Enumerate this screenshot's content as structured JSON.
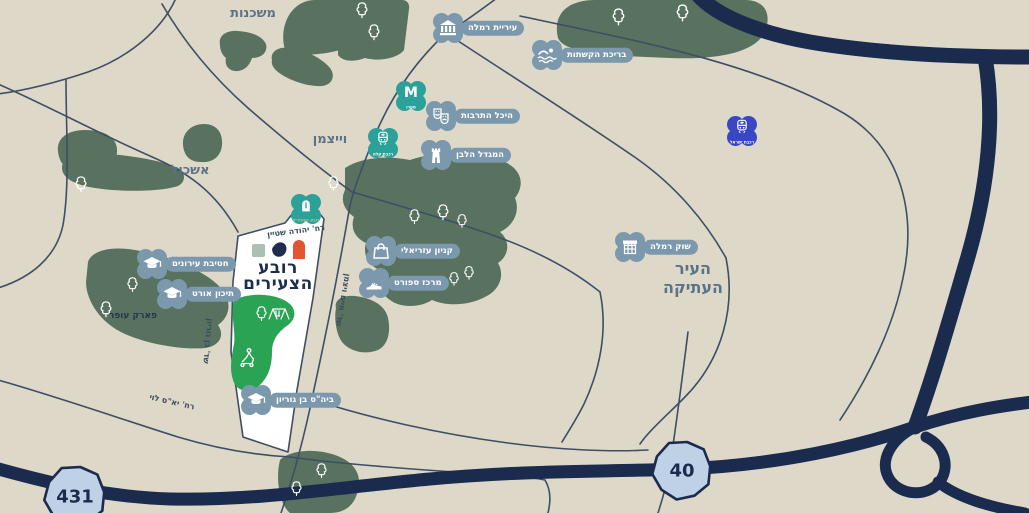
{
  "colors": {
    "background": "#ded8c9",
    "green_area": "#58725f",
    "bright_park": "#2aa355",
    "thin_road": "#3e4e64",
    "major_road": "#1b2b4d",
    "quarter_fill": "#ffffff",
    "marker_slate": "#7b98ad",
    "marker_teal": "#2ba19a",
    "marker_blue": "#3a47c4",
    "badge_fill": "#bed1e6",
    "region_text": "#5b7386",
    "logo_navy": "#1e2c50",
    "logo_orange": "#e1552f",
    "logo_sage": "#a9c0b2"
  },
  "logo": {
    "line1": "רובע",
    "line2": "הצעירים"
  },
  "regions": [
    {
      "id": "mishkenot",
      "text": "משכנות",
      "x": 253,
      "y": 14,
      "size": 13
    },
    {
      "id": "weizmann",
      "text": "וייצמן",
      "x": 330,
      "y": 140,
      "size": 13
    },
    {
      "id": "eshkol",
      "text": "אשכול",
      "x": 190,
      "y": 171,
      "size": 13
    },
    {
      "id": "old-city",
      "text": "העיר\nהעתיקה",
      "x": 693,
      "y": 278,
      "size": 16
    },
    {
      "id": "ofer-park",
      "text": "פארק עופר",
      "x": 133,
      "y": 316,
      "size": 9,
      "park": true
    }
  ],
  "streets": [
    {
      "id": "yehuda-stein",
      "text": "רח' יהודה שטיין",
      "x": 296,
      "y": 231,
      "rot": -7
    },
    {
      "id": "haim-weizmann",
      "text": "שד' חיים ויצמן",
      "x": 343,
      "y": 300,
      "rot": 100
    },
    {
      "id": "ben-gurion-blvd",
      "text": "שד' בן גוריון",
      "x": 208,
      "y": 341,
      "rot": 95
    },
    {
      "id": "yas-levi",
      "text": "רח' יא\"ס לוי",
      "x": 172,
      "y": 402,
      "rot": 13
    }
  ],
  "road_badges": [
    {
      "id": "badge-431",
      "text": "431",
      "x": 75,
      "y": 496,
      "r": 31
    },
    {
      "id": "badge-40",
      "text": "40",
      "x": 682,
      "y": 470,
      "r": 30
    }
  ],
  "markers": [
    {
      "name": "city-hall",
      "icon": "bank",
      "label": "עיריית רמלה",
      "x": 448,
      "y": 28,
      "style": "slate"
    },
    {
      "name": "arches-pool",
      "icon": "swimmer",
      "label": "בריכת הקשתות",
      "x": 547,
      "y": 55,
      "style": "slate"
    },
    {
      "name": "metro-station",
      "icon": "metro",
      "label": "",
      "sub": "מטרו",
      "x": 411,
      "y": 96,
      "style": "teal"
    },
    {
      "name": "culture-hall",
      "icon": "masks",
      "label": "היכל התרבות",
      "x": 441,
      "y": 116,
      "style": "slate"
    },
    {
      "name": "white-tower",
      "icon": "tower",
      "label": "המגדל הלבן",
      "x": 436,
      "y": 155,
      "style": "slate"
    },
    {
      "name": "light-rail-stop",
      "icon": "train",
      "label": "",
      "sub": "רכבת קלה",
      "x": 383,
      "y": 143,
      "style": "teal"
    },
    {
      "name": "israel-railways",
      "icon": "train",
      "label": "",
      "sub": "רכבת ישראל",
      "x": 742,
      "y": 131,
      "style": "blue"
    },
    {
      "name": "young-quarter-mark",
      "icon": "arch",
      "label": "",
      "sub": "רובע הצעירים",
      "x": 306,
      "y": 209,
      "style": "teal",
      "sub_color": "#f2a98e"
    },
    {
      "name": "azrieli-mall",
      "icon": "bag",
      "label": "קניון עזריאלי",
      "x": 381,
      "y": 251,
      "style": "slate"
    },
    {
      "name": "sports-center",
      "icon": "sneaker",
      "label": "מרכז ספורט",
      "x": 374,
      "y": 283,
      "style": "slate"
    },
    {
      "name": "urban-middle-school",
      "icon": "cap",
      "label": "חטיבת עירונים",
      "x": 152,
      "y": 264,
      "style": "slate"
    },
    {
      "name": "ort-high-school",
      "icon": "cap",
      "label": "תיכון אורט",
      "x": 172,
      "y": 294,
      "style": "slate"
    },
    {
      "name": "ramla-market",
      "icon": "stall",
      "label": "שוק רמלה",
      "x": 630,
      "y": 247,
      "style": "slate"
    },
    {
      "name": "ben-gurion-school",
      "icon": "cap",
      "label": "ביה\"ס בן גוריון",
      "x": 256,
      "y": 400,
      "style": "slate"
    }
  ],
  "nature": {
    "trees": [
      [
        355,
        1,
        14
      ],
      [
        367,
        23,
        14
      ],
      [
        611,
        7,
        15
      ],
      [
        675,
        3,
        15
      ],
      [
        74,
        175,
        14
      ],
      [
        327,
        175,
        13
      ],
      [
        99,
        300,
        14
      ],
      [
        126,
        276,
        13
      ],
      [
        408,
        208,
        13
      ],
      [
        436,
        203,
        14
      ],
      [
        456,
        213,
        12
      ],
      [
        448,
        271,
        12
      ],
      [
        463,
        265,
        12
      ],
      [
        290,
        480,
        13
      ],
      [
        315,
        462,
        13
      ],
      [
        255,
        305,
        13
      ]
    ],
    "icons": [
      "tree-icon",
      "playground-icon",
      "scooter-icon"
    ]
  }
}
